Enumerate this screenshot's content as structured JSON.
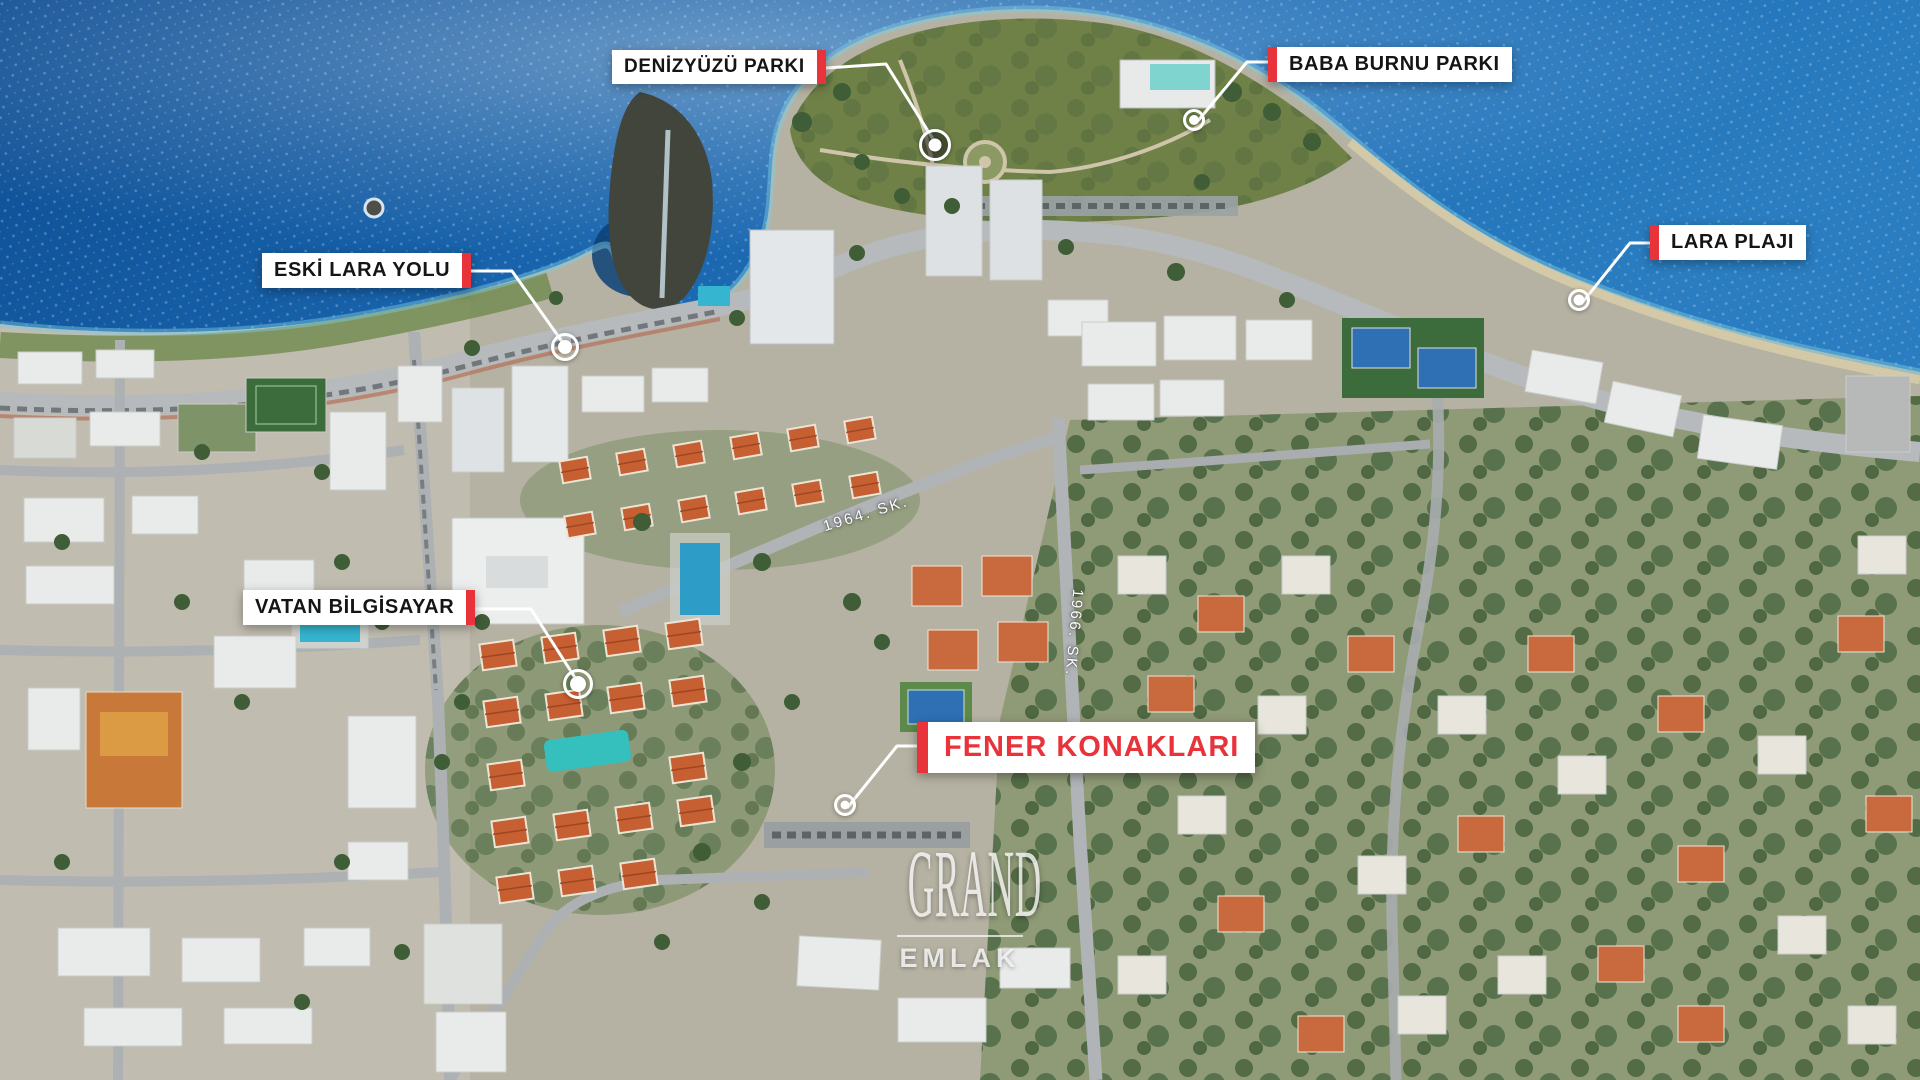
{
  "callouts": [
    {
      "id": "denizyuzu-parki",
      "text": "DENİZYÜZÜ PARKI",
      "accent_side": "right",
      "style": "dark-on-white"
    },
    {
      "id": "baba-burnu-parki",
      "text": "BABA BURNU PARKI",
      "accent_side": "left",
      "style": "dark-on-white"
    },
    {
      "id": "eski-lara-yolu",
      "text": "ESKİ LARA YOLU",
      "accent_side": "right",
      "style": "dark-on-white"
    },
    {
      "id": "lara-plaji",
      "text": "LARA PLAJI",
      "accent_side": "left",
      "style": "dark-on-white"
    },
    {
      "id": "vatan-bilgisayar",
      "text": "VATAN BİLGİSAYAR",
      "accent_side": "right",
      "style": "dark-on-white"
    },
    {
      "id": "fener-konaklari",
      "text": "FENER KONAKLARI",
      "accent_side": "left",
      "style": "red-on-white",
      "featured": true
    }
  ],
  "street_labels": [
    {
      "name": "1964. SK."
    },
    {
      "name": "1966. SK."
    }
  ],
  "watermark": {
    "line1": "GRAND",
    "line2": "EMLAK"
  },
  "colors": {
    "accent_red": "#e8333a",
    "label_bg": "#ffffff",
    "label_text": "#151515",
    "featured_text": "#e8333a",
    "connector": "#ffffff",
    "sea_deep": "#0d4c92",
    "sea_light": "#2a7dc0",
    "villa_roof": "#c65f32",
    "park_green": "#68824a"
  }
}
